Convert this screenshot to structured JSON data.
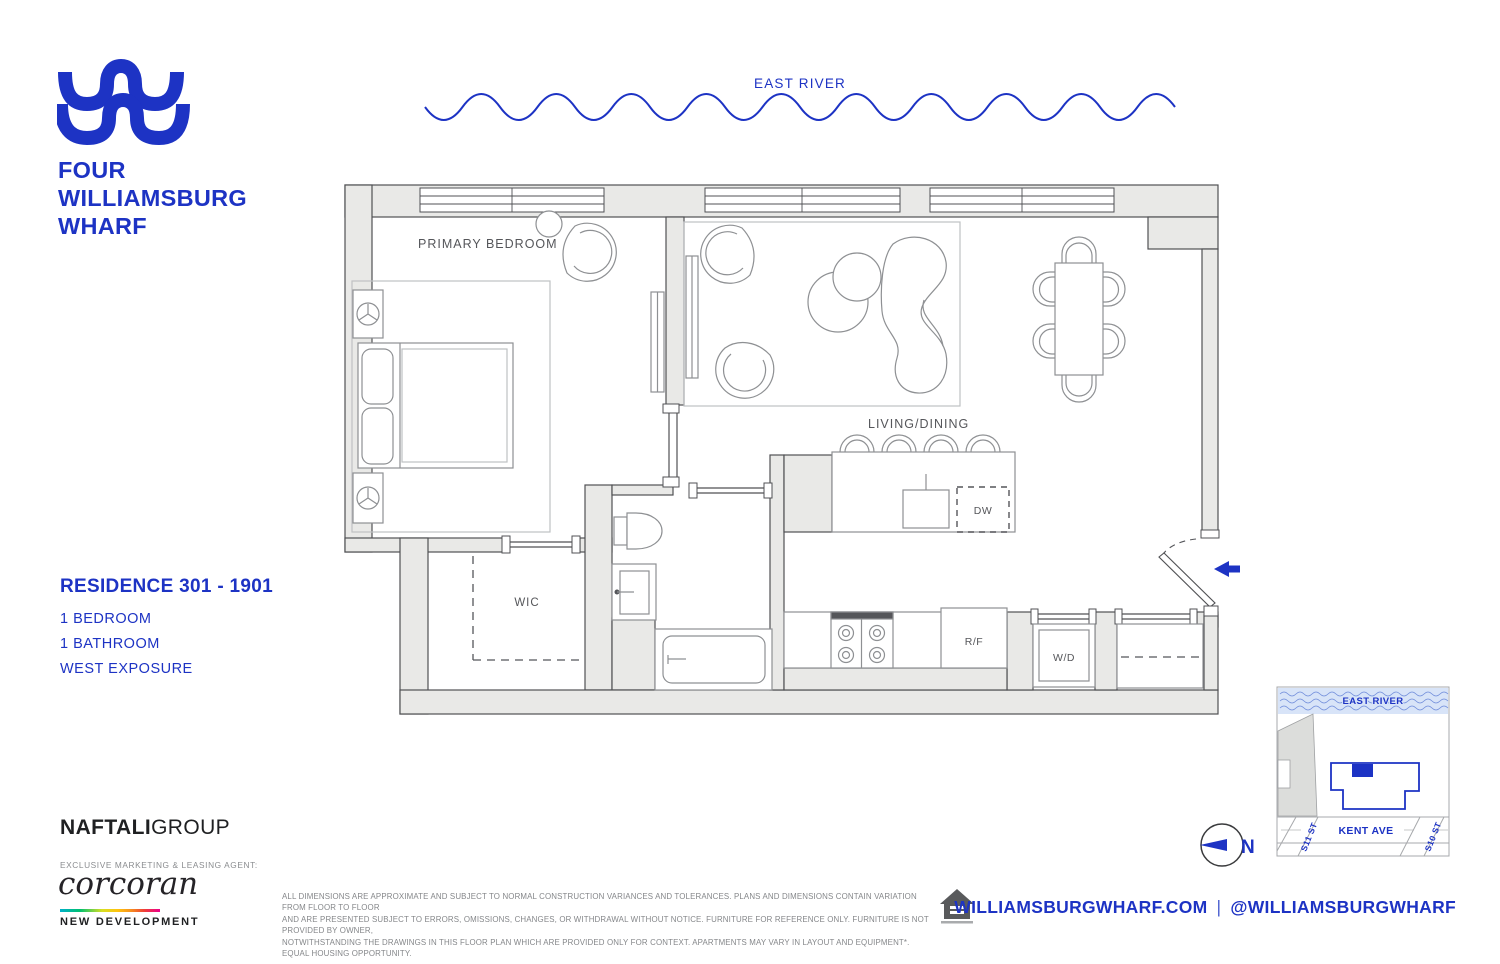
{
  "colors": {
    "brand_blue": "#1D33C4",
    "wall_gray": "#E9E9E7",
    "line_dark": "#505154",
    "furniture_gray": "#8E9093",
    "text_gray": "#55565A"
  },
  "logo": {
    "line1": "FOUR",
    "line2": "WILLIAMSBURG",
    "line3": "WHARF"
  },
  "east_river_header": "EAST RIVER",
  "plan_labels": {
    "primary_bedroom": "PRIMARY BEDROOM",
    "living_dining": "LIVING/DINING",
    "wic": "WIC",
    "dw": "DW",
    "rf": "R/F",
    "wd": "W/D"
  },
  "residence": {
    "title": "RESIDENCE 301 - 1901",
    "detail1": "1 BEDROOM",
    "detail2": "1 BATHROOM",
    "detail3": "WEST EXPOSURE"
  },
  "map": {
    "east_river": "EAST RIVER",
    "kent_ave": "KENT AVE",
    "s11": "S11 ST",
    "s10": "S10 ST",
    "north": "N"
  },
  "footer": {
    "developer_bold": "NAFTALI",
    "developer_light": "GROUP",
    "agent_label": "EXCLUSIVE MARKETING & LEASING AGENT:",
    "agent_name": "corcoran",
    "agent_division": "NEW DEVELOPMENT",
    "disclaimer_line1": "ALL DIMENSIONS ARE APPROXIMATE AND SUBJECT TO NORMAL CONSTRUCTION VARIANCES AND TOLERANCES. PLANS AND DIMENSIONS CONTAIN VARIATION FROM FLOOR TO FLOOR",
    "disclaimer_line2": "AND ARE PRESENTED SUBJECT TO ERRORS, OMISSIONS, CHANGES, OR WITHDRAWAL WITHOUT NOTICE. FURNITURE FOR REFERENCE ONLY. FURNITURE IS NOT PROVIDED BY OWNER,",
    "disclaimer_line3": "NOTWITHSTANDING THE DRAWINGS IN THIS FLOOR PLAN WHICH ARE PROVIDED ONLY FOR CONTEXT. APARTMENTS MAY VARY IN LAYOUT AND EQUIPMENT*. EQUAL HOUSING OPPORTUNITY.",
    "website": "WILLIAMSBURGWHARF.COM",
    "separator": "|",
    "social": "@WILLIAMSBURGWHARF"
  }
}
